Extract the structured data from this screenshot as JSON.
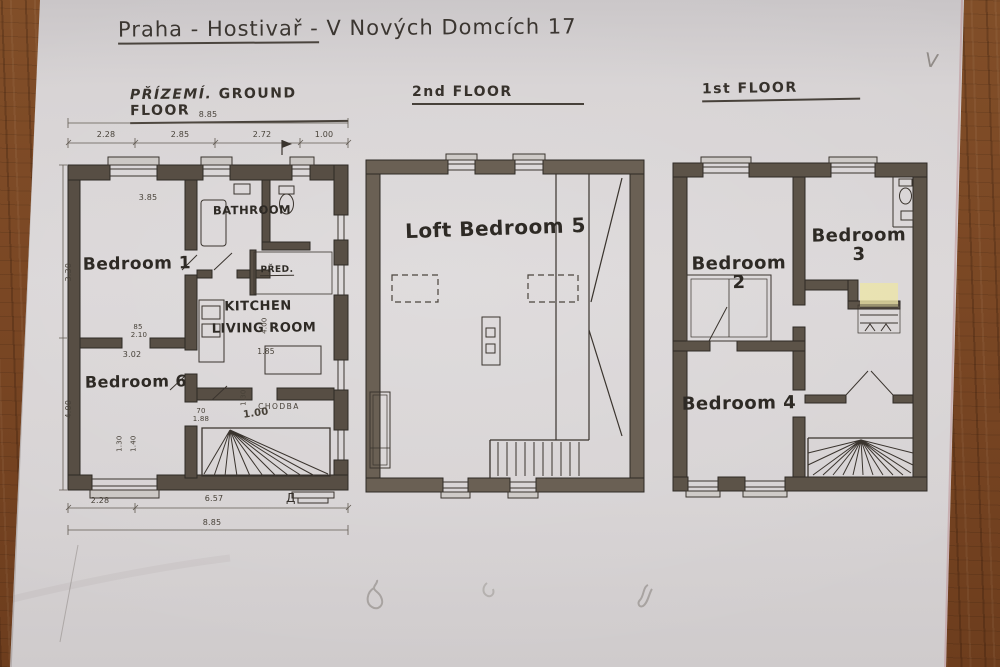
{
  "title": {
    "part1": "Praha - Hostivař -",
    "part2": " V Nových Domcích 17"
  },
  "corner_mark": "V",
  "plans": {
    "ground": {
      "heading_cz": "PŘÍZEMÍ.",
      "heading_en": "GROUND FLOOR",
      "rooms": {
        "bedroom1": "Bedroom 1",
        "bathroom": "BATHROOM",
        "pred": "PŘED.",
        "kitchen1": "KITCHEN",
        "kitchen2": "LIVING ROOM",
        "bedroom6": "Bedroom 6",
        "chodba": "CHODBA"
      },
      "dims": {
        "top_total": "8.85",
        "top_segments": [
          "2.28",
          "2.85",
          "2.72",
          "1.00"
        ],
        "bed1_width": "3.85",
        "left_upper": "3.30",
        "left_lower": "4.00",
        "window_w": "1.30",
        "window_w2": "1.40",
        "bed6_width": "3.02",
        "door_w": "85",
        "door_h": "2.10",
        "stair_w": "1.00",
        "kitchen_depth": "4.00",
        "table_w": "1.85",
        "hall_w": "1.30",
        "small_w": "70",
        "small_h": "1.88",
        "bottom_left": "2.28",
        "bottom_mid": "6.57",
        "bottom_total": "8.85"
      },
      "marks": {
        "section": "Д"
      }
    },
    "second": {
      "heading": "2nd FLOOR",
      "rooms": {
        "loft": "Loft Bedroom 5"
      }
    },
    "first": {
      "heading": "1st FLOOR",
      "rooms": {
        "bedroom2": "Bedroom 2",
        "bedroom3": "Bedroom 3",
        "bedroom4": "Bedroom 4"
      }
    }
  },
  "colors": {
    "paper": "#d8d4d5",
    "wood": "#7a4724",
    "ink": "#35302b",
    "wall": "#574e44",
    "highlight": "#ece5a8"
  }
}
